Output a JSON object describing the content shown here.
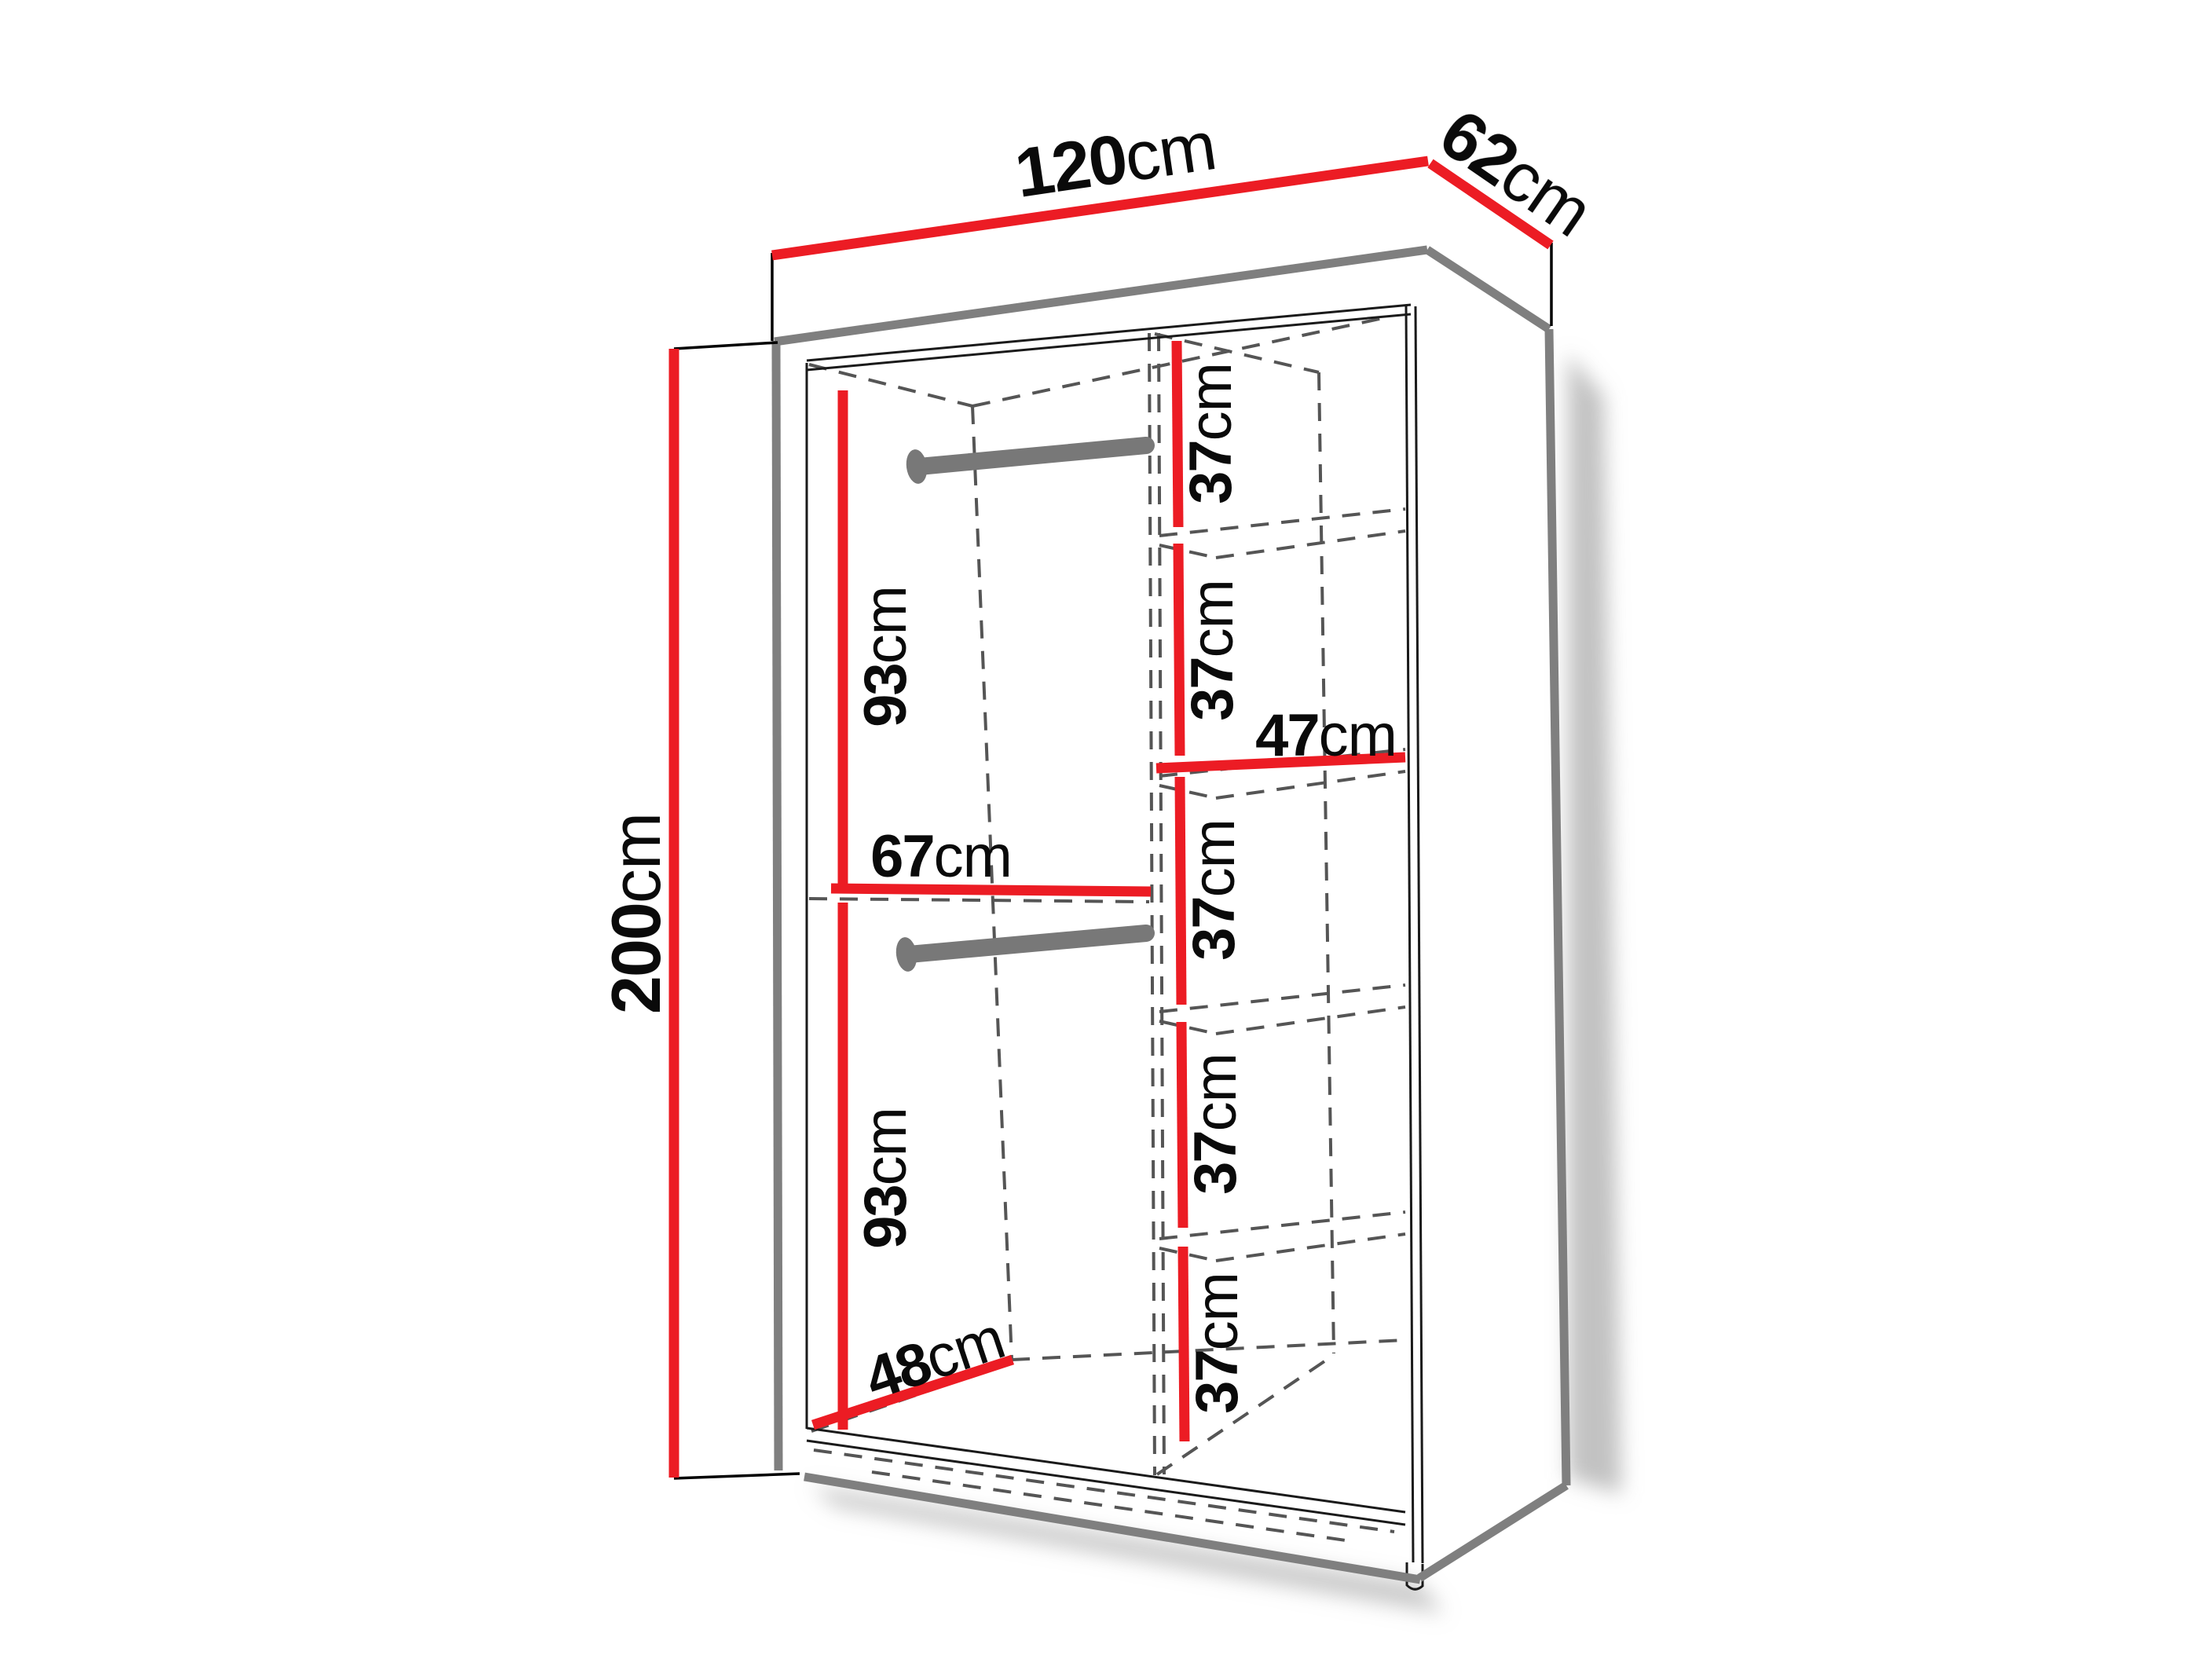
{
  "diagram": {
    "background": "#ffffff",
    "colors": {
      "dimension_line": "#EC1C24",
      "outer_edge": "#7F7F7F",
      "interior_line": "#1A1A1A",
      "hidden_dash": "#555555",
      "rail": "#787878",
      "label_text": "#0A0A0A"
    },
    "dimensions": {
      "width": {
        "value": "120",
        "unit": "cm"
      },
      "depth": {
        "value": "62",
        "unit": "cm"
      },
      "height": {
        "value": "200",
        "unit": "cm"
      },
      "hanging_top": {
        "value": "93",
        "unit": "cm"
      },
      "hanging_bottom": {
        "value": "93",
        "unit": "cm"
      },
      "hanging_width": {
        "value": "67",
        "unit": "cm"
      },
      "shelf_width": {
        "value": "47",
        "unit": "cm"
      },
      "usable_depth": {
        "value": "48",
        "unit": "cm"
      },
      "shelf_spacings": [
        {
          "value": "37",
          "unit": "cm"
        },
        {
          "value": "37",
          "unit": "cm"
        },
        {
          "value": "37",
          "unit": "cm"
        },
        {
          "value": "37",
          "unit": "cm"
        },
        {
          "value": "37",
          "unit": "cm"
        }
      ]
    }
  }
}
